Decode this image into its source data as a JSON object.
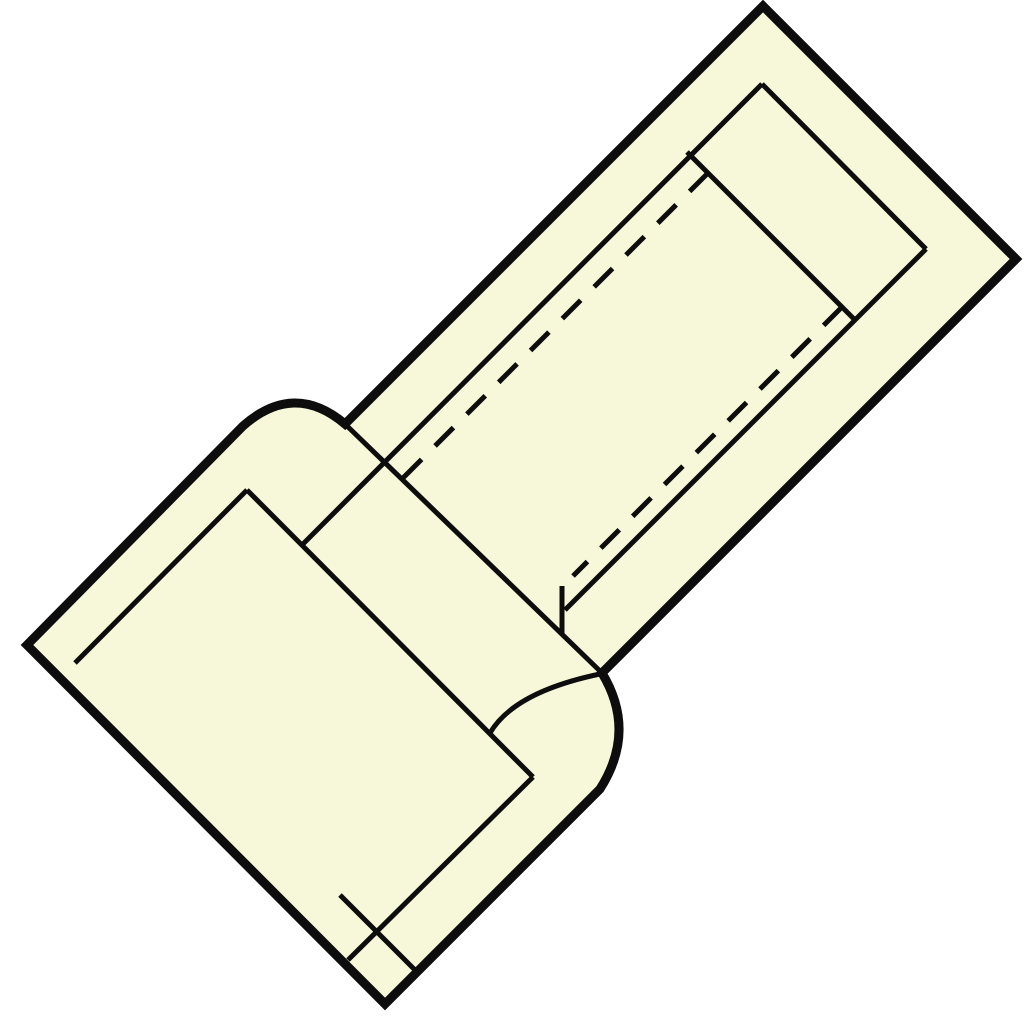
{
  "canvas": {
    "width": 1024,
    "height": 1024,
    "background_color": "#ffffff"
  },
  "figure": {
    "description": "technical line drawing of a crimp butt connector shown diagonally",
    "body_fill_color": "#f7f8da",
    "line_color": "#0d0d0d",
    "outer_stroke_width": 9,
    "inner_stroke_width": 5,
    "hidden_line_dash_pattern": "26 19",
    "outline": {
      "name": "connector-outer-outline",
      "d": "M 763 6 L 1016 259 L 602 673 Q 637 731 600 789 L 385 1004 L 27 645 L 243 426 Q 294 381 345 424 Z"
    },
    "solid_lines": [
      {
        "name": "body-inner-end-edge",
        "d": "M 762 84 L 926 249"
      },
      {
        "name": "body-inner-topleft-edge",
        "d": "M 762 84 L 302 545"
      },
      {
        "name": "body-inner-bottomright-edge",
        "d": "M 926 249 L 565 610"
      },
      {
        "name": "body-end-edge",
        "d": "M 345 424 L 602 673"
      },
      {
        "name": "tube-end-edge",
        "d": "M 687 152 L 855 320"
      },
      {
        "name": "bore-end-tick",
        "d": "M 562 586 L 562 634"
      },
      {
        "name": "sleeve-inner-topleft-edge",
        "d": "M 75 663 L 247 490"
      },
      {
        "name": "sleeve-inner-end-edge",
        "d": "M 247 490 L 533 777"
      },
      {
        "name": "collar-inner-arc",
        "d": "M 490 733 Q 514 692 600 674"
      },
      {
        "name": "sleeve-inner-bottomright-edge",
        "d": "M 533 777 L 348 960"
      },
      {
        "name": "sleeve-inner-mouth-edge",
        "d": "M 340 895 L 416 971"
      }
    ],
    "dashed_lines": [
      {
        "name": "bore-hidden-edge-upper",
        "d": "M 708 173 L 403 478"
      },
      {
        "name": "bore-hidden-edge-lower",
        "d": "M 842 307 L 573 576"
      }
    ]
  }
}
